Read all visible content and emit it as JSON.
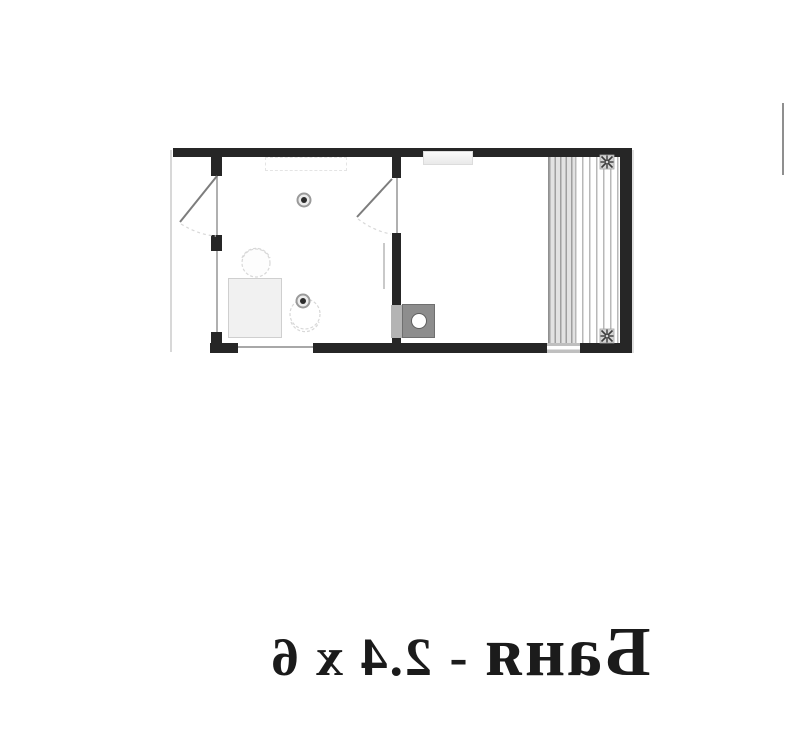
{
  "caption": {
    "full_text": "Баня - 2.4 x 6",
    "name": "Баня",
    "separator": " - ",
    "dimensions": "2.4 x 6",
    "mirrored": true,
    "color": "#1b1b1b"
  },
  "plan": {
    "type": "floor-plan",
    "colors": {
      "wall": "#262626",
      "opening_line": "#b0b0b0",
      "door_leaf": "#7d7d7d",
      "swing_arc": "#d8d8d8",
      "furniture_fill": "#f1f1f1",
      "furniture_border": "#cfcfcf",
      "chair_outline": "#d8d8d8",
      "bench_fill": "#e2e2e2",
      "bench_stripe": "#9f9f9f",
      "bench_line": "#b8b8b8",
      "window_fill": "#bfbfbf",
      "stove_fill": "#8d8d8d",
      "stove_border": "#6f6f6f",
      "stove_pass": "#b4b4b4",
      "light_ring": "#9a9a9a",
      "light_center": "#2c2c2c",
      "fan_square": "#d4d4d4",
      "fan_glyph_color": "#3c3c3c"
    },
    "icons": {
      "ceiling_light": "circle-with-dot",
      "vent_fan": "✳",
      "stove": "square-with-circle"
    }
  }
}
